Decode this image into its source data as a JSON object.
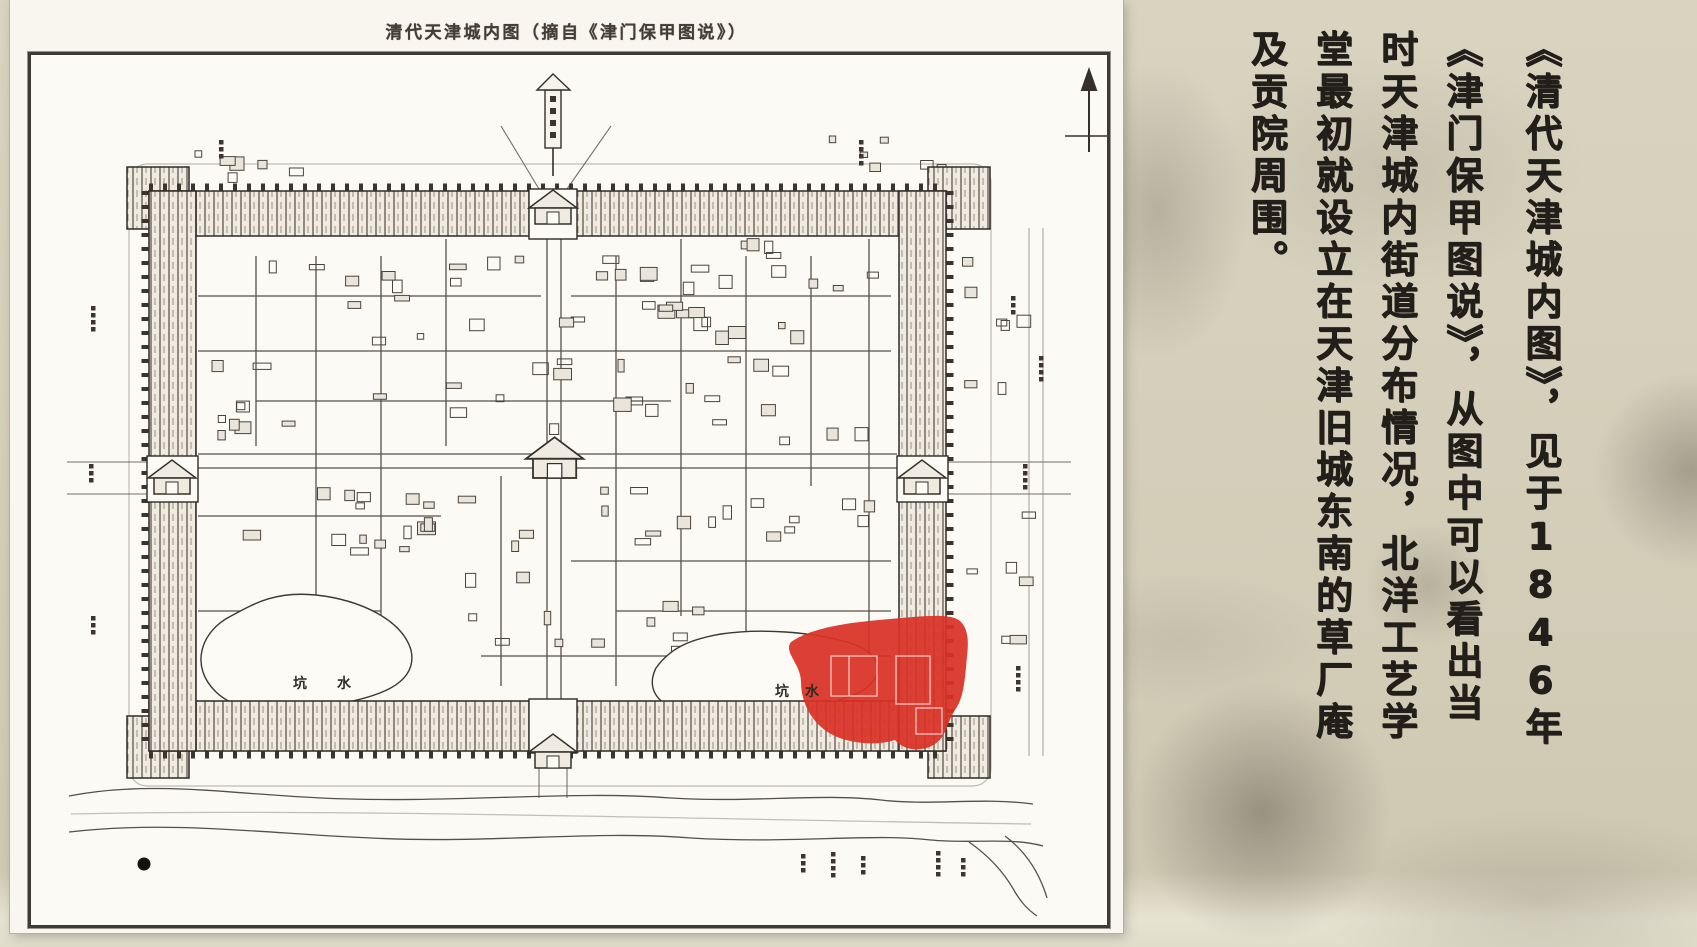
{
  "map_panel": {
    "title": "清代天津城内图（摘自《津门保甲图说》）",
    "pond_labels": {
      "west": "坑水",
      "south": "坑水"
    },
    "highlight_color": "#d93126"
  },
  "caption": {
    "columns": [
      "《清代天津城内图》，见于1846年",
      "《津门保甲图说》，从图中可以看出当",
      "时天津城内街道分布情况，北洋工艺学",
      "堂最初就设立在天津旧城东南的草厂庵",
      "及贡院周围。"
    ]
  }
}
